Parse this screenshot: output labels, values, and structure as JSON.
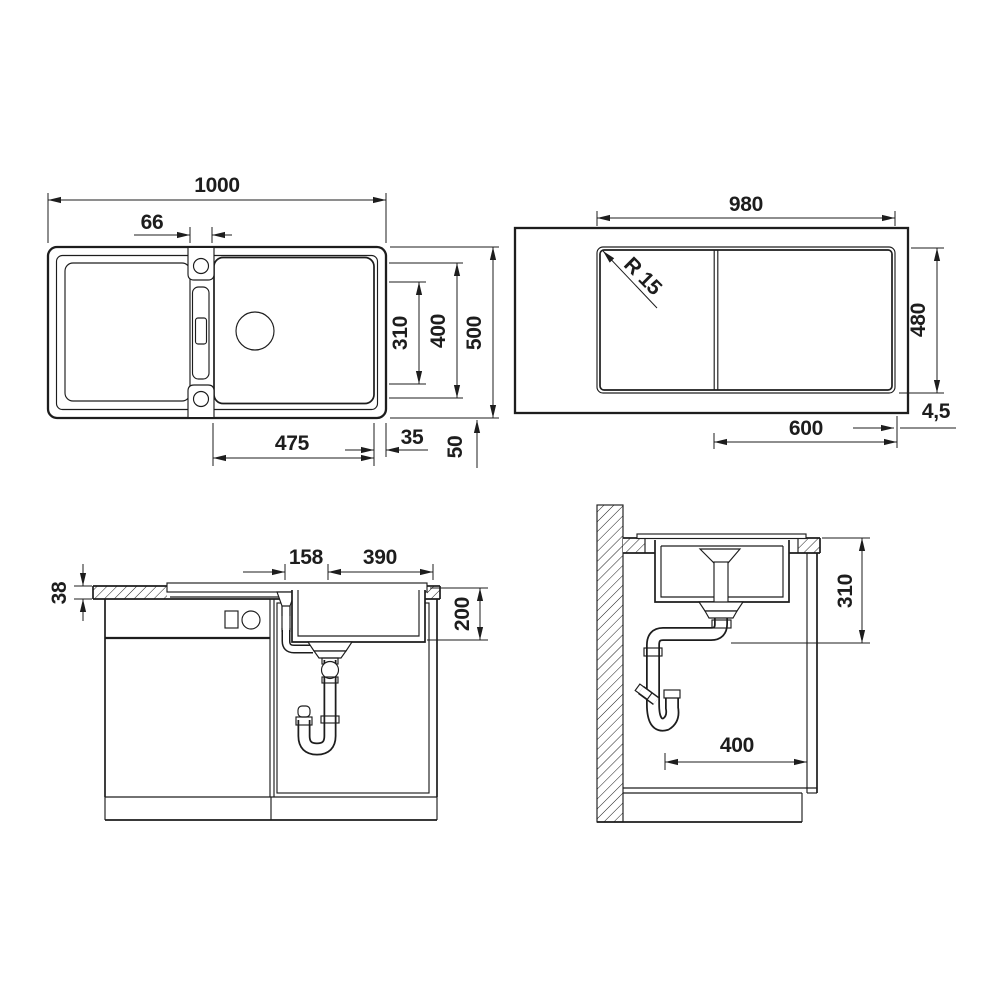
{
  "colors": {
    "ink": "#1d1d1d",
    "paper": "#ffffff"
  },
  "views": {
    "top": {
      "title": "sink top view",
      "dims": {
        "overall_width": "1000",
        "tap_ledge": "66",
        "bowl_inner_depth": "310",
        "bowl_outer_depth": "400",
        "overall_depth": "500",
        "bowl_width": "475",
        "edge_gap": "35",
        "rear_gap": "50"
      }
    },
    "cutout": {
      "title": "worktop cutout view",
      "dims": {
        "cutout_width": "980",
        "corner_radius": "R 15",
        "cutout_depth": "480",
        "edge_detail": "4,5",
        "base_cabinet": "600"
      }
    },
    "front": {
      "title": "front section view",
      "dims": {
        "worktop_thickness": "38",
        "overflow_to_drain": "158",
        "drain_to_edge": "390",
        "bowl_depth": "200"
      }
    },
    "side": {
      "title": "side section view",
      "dims": {
        "drain_height": "310",
        "trap_distance": "400"
      }
    }
  }
}
